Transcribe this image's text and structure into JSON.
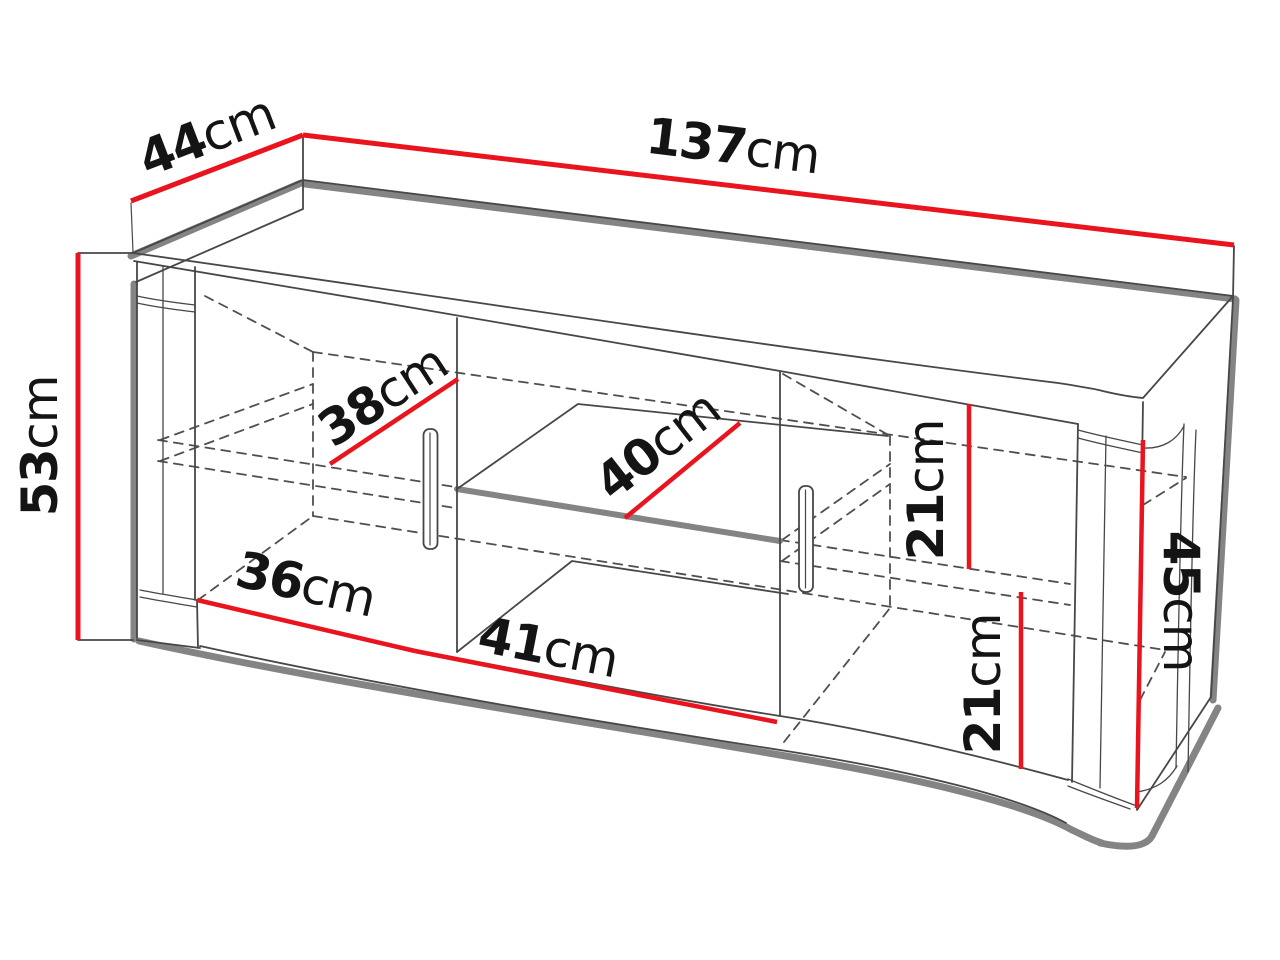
{
  "diagram": {
    "type": "furniture-dimension-drawing",
    "subject": "TV stand / sideboard with two doors, middle open niche and shelf",
    "unit": "cm",
    "dimensions": {
      "top_depth": {
        "number": "44",
        "unit": "cm"
      },
      "top_width": {
        "number": "137",
        "unit": "cm"
      },
      "left_height": {
        "number": "53",
        "unit": "cm"
      },
      "left_inner_depth": {
        "number": "38",
        "unit": "cm"
      },
      "shelf_depth": {
        "number": "40",
        "unit": "cm"
      },
      "right_upper_gap": {
        "number": "21",
        "unit": "cm"
      },
      "right_inner_height": {
        "number": "45",
        "unit": "cm"
      },
      "left_inner_width": {
        "number": "36",
        "unit": "cm"
      },
      "niche_width": {
        "number": "41",
        "unit": "cm"
      },
      "right_lower_gap": {
        "number": "21",
        "unit": "cm"
      }
    },
    "colors": {
      "dimension_line": "#e9141e",
      "drawing_line": "#474747",
      "faint_line": "#8a8a8a",
      "hidden_line": "#4f4f4f",
      "shadow_line": "#848484",
      "label_text": "#141414",
      "background": "#ffffff"
    }
  }
}
